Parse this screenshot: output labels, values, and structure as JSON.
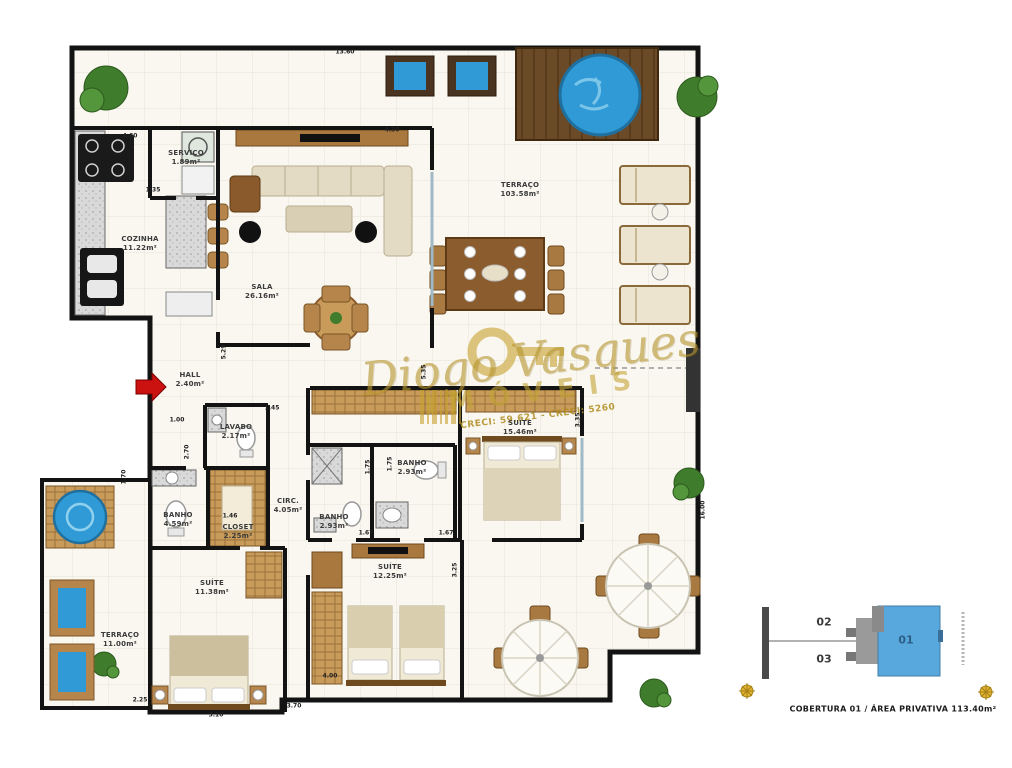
{
  "plan": {
    "rooms": [
      {
        "name": "SERVIÇO",
        "area": "1.89m²"
      },
      {
        "name": "COZINHA",
        "area": "11.22m²"
      },
      {
        "name": "SALA",
        "area": "26.16m²"
      },
      {
        "name": "TERRAÇO",
        "area": "103.58m²"
      },
      {
        "name": "HALL",
        "area": "2.40m²"
      },
      {
        "name": "LAVABO",
        "area": "2.17m²"
      },
      {
        "name": "CIRC.",
        "area": "4.05m²"
      },
      {
        "name": "BANHO",
        "area": "2.93m²"
      },
      {
        "name": "BANHO",
        "area": "2.93m²"
      },
      {
        "name": "BANHO",
        "area": "4.59m²"
      },
      {
        "name": "CLOSET",
        "area": "2.25m²"
      },
      {
        "name": "SUÍTE",
        "area": "15.46m²"
      },
      {
        "name": "SUÍTE",
        "area": "12.25m²"
      },
      {
        "name": "SUÍTE",
        "area": "11.38m²"
      },
      {
        "name": "TERRAÇO",
        "area": "11.00m²"
      }
    ],
    "dims": [
      "13.60",
      "4.60",
      "1.35",
      "4.30",
      "1.00",
      "2.70",
      "1.45",
      "5.29",
      "5.35",
      "3.35",
      "1.70",
      "1.46",
      "1.75",
      "1.75",
      "1.67",
      "1.67",
      "3.25",
      "4.00",
      "3.70",
      "3.10",
      "2.25",
      "16.00"
    ],
    "watermark": {
      "name": "Diogo Vasques",
      "type": "IMÓVEIS",
      "creci": "CRECI: 59.621 - CRECI: 5260"
    }
  },
  "keyplan": {
    "units": [
      {
        "label": "02",
        "highlighted": false
      },
      {
        "label": "03",
        "highlighted": false
      },
      {
        "label": "01",
        "highlighted": true
      }
    ],
    "caption": "COBERTURA 01 / ÁREA PRIVATIVA 113.40m²",
    "highlight_color": "#58a7dd"
  },
  "colors": {
    "wall": "#131313",
    "wood": "#c89b5a",
    "wood_dark": "#7a5526",
    "pool_water": "#2f9ad6",
    "gold": "#c9a22e",
    "floor": "#f9f7f0",
    "plant_green": "#3f7d2c",
    "entry_arrow_red": "#cc1111"
  }
}
